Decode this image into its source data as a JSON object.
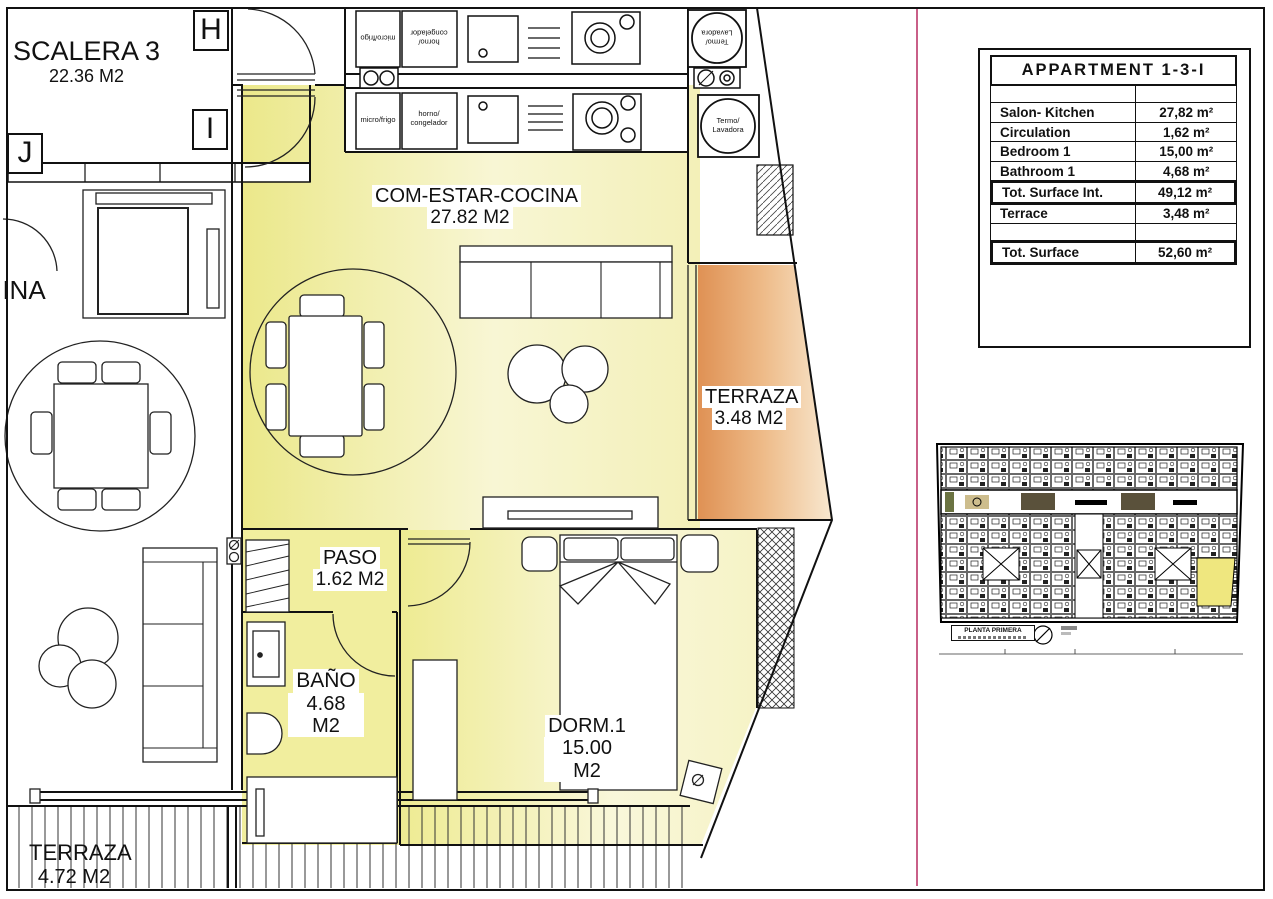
{
  "frame": {
    "divider_color": "#c95f88"
  },
  "plan": {
    "grid_letters": {
      "h": "H",
      "i": "I",
      "j": "J"
    },
    "labels": {
      "escalera": {
        "name": "SCALERA 3",
        "area": "22.36 M2"
      },
      "living": {
        "name": "COM-ESTAR-COCINA",
        "area": "27.82 M2"
      },
      "terrace": {
        "name": "TERRAZA",
        "area": "3.48 M2"
      },
      "paso": {
        "name": "PASO",
        "area": "1.62 M2"
      },
      "bano": {
        "name": "BAÑO",
        "area": "4.68 M2"
      },
      "dorm": {
        "name": "DORM.1",
        "area": "15.00 M2"
      },
      "terrace_lower": {
        "name": "TERRAZA",
        "area": "4.72 M2"
      },
      "neighbor_room_partial": "INA"
    },
    "appliances": {
      "micro_frigo": "micro/frigo",
      "horno_line1": "horno/",
      "horno_line2": "congelador",
      "termo_line1": "Termo/",
      "termo_line2": "Lavadora"
    },
    "colors": {
      "room_fill": "#ebe88a",
      "room_fill_light": "#f8f6d4",
      "terrace_fill": "#df9154",
      "terrace_fill_light": "#f8e8d0"
    }
  },
  "summary_table": {
    "title": "APPARTMENT 1-3-I",
    "rows": [
      {
        "label": "Salon- Kitchen",
        "value": "27,82 m²"
      },
      {
        "label": "Circulation",
        "value": "1,62 m²"
      },
      {
        "label": "Bedroom 1",
        "value": "15,00 m²"
      },
      {
        "label": "Bathroom 1",
        "value": "4,68 m²"
      },
      {
        "label": "Tot. Surface Int.",
        "value": "49,12 m²"
      },
      {
        "label": "Terrace",
        "value": "3,48 m²"
      },
      {
        "label": "Tot. Surface",
        "value": "52,60 m²"
      }
    ]
  },
  "overview": {
    "caption": "PLANTA PRIMERA"
  }
}
